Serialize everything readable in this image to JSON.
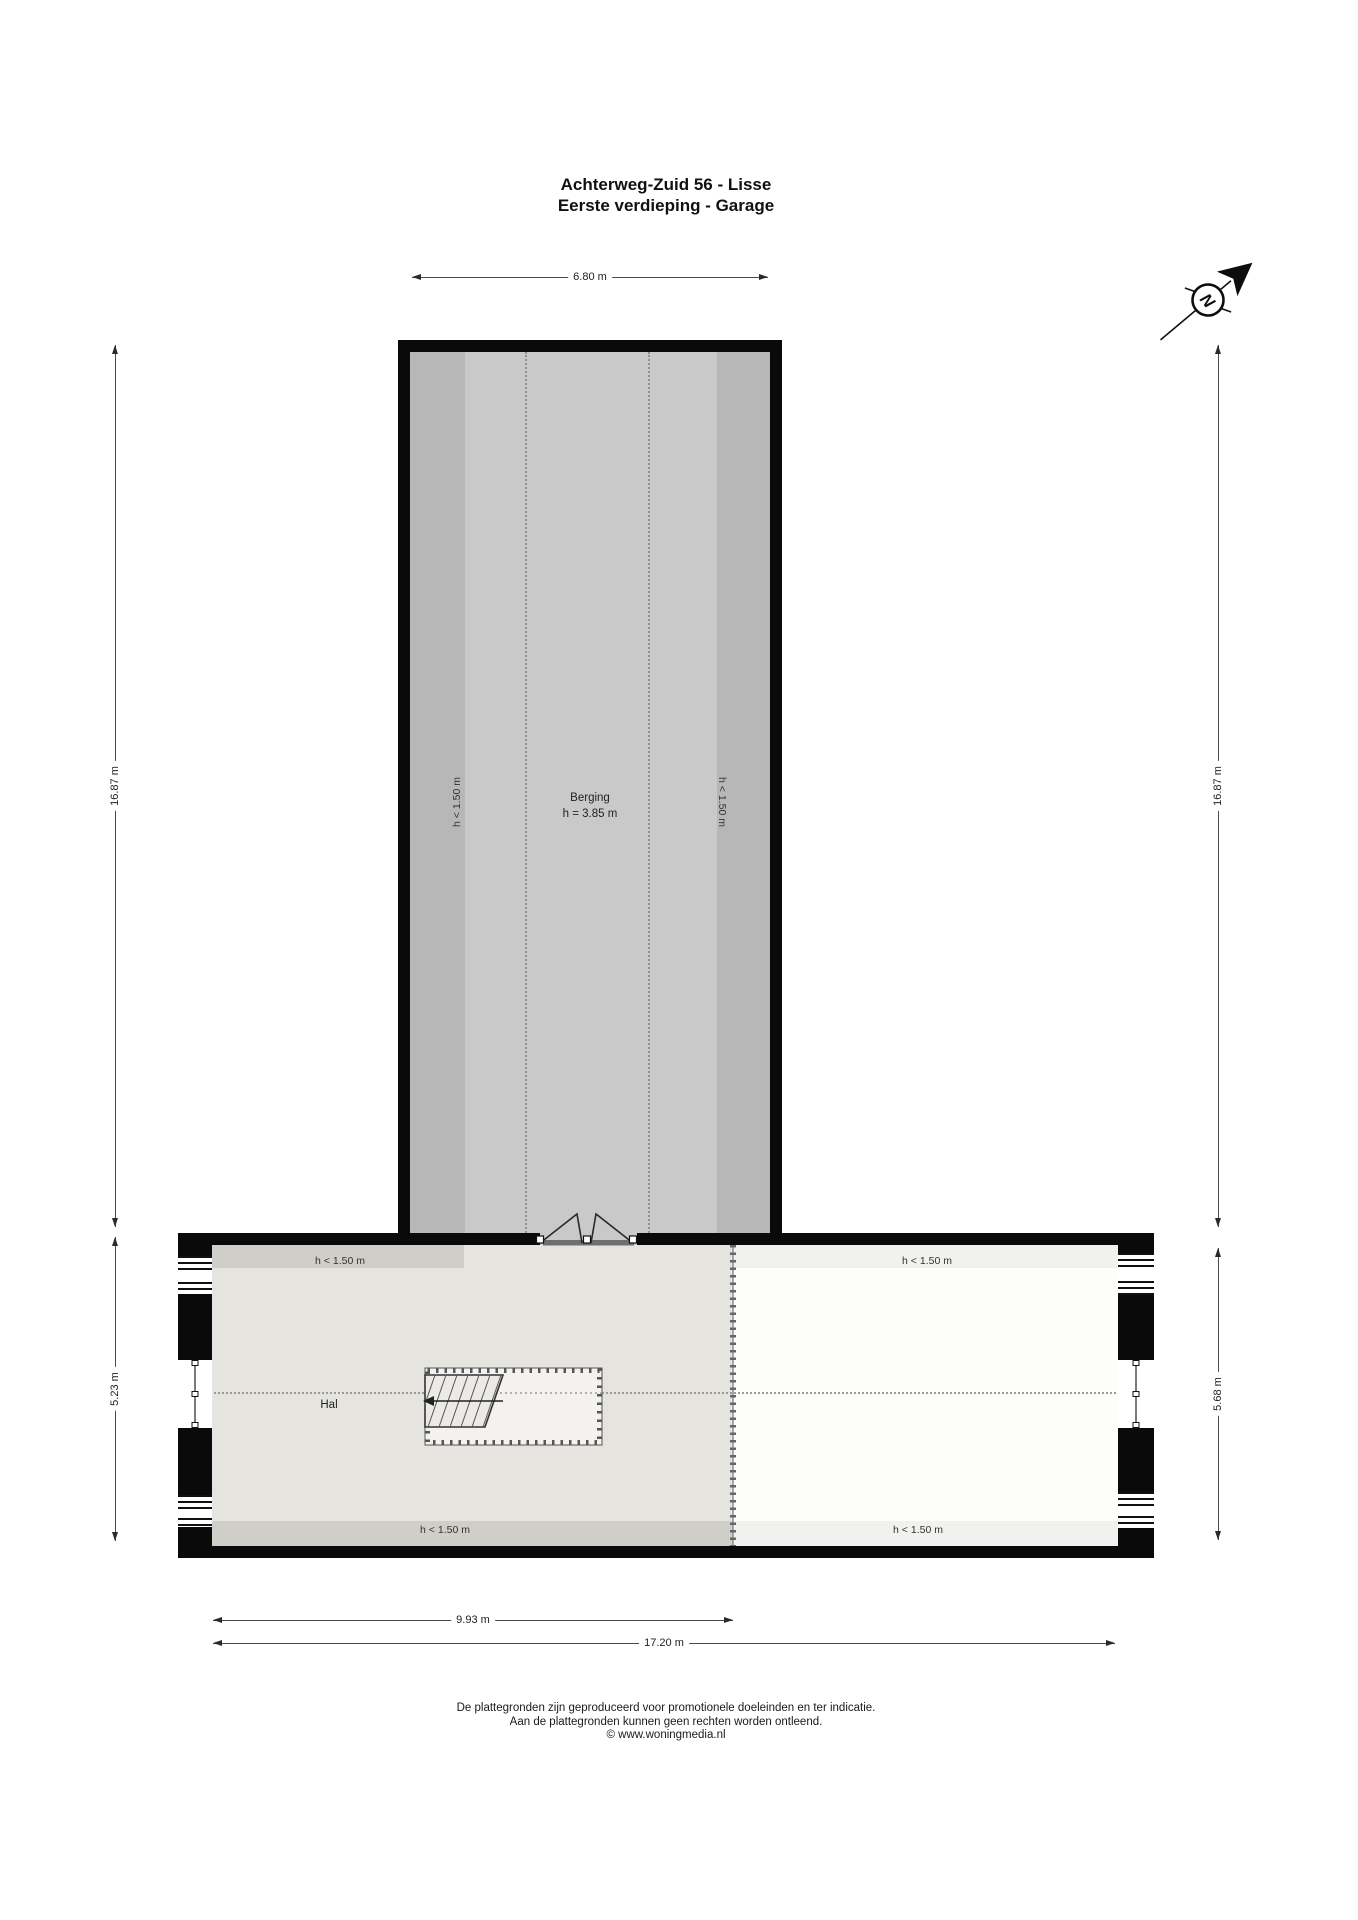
{
  "title": {
    "line1": "Achterweg-Zuid 56 - Lisse",
    "line2": "Eerste verdieping - Garage"
  },
  "compass": {
    "north_label": "N"
  },
  "labels": {
    "low_height": "h < 1.50 m"
  },
  "rooms": {
    "berging": {
      "name": "Berging",
      "height_note": "h = 3.85 m"
    },
    "hal": {
      "name": "Hal"
    }
  },
  "dimensions": {
    "berging_width": "6.80 m",
    "left_total_height": "16.87 m",
    "right_total_height": "16.87 m",
    "hal_section_height": "5.23 m",
    "right_section_height": "5.68 m",
    "hal_width": "9.93 m",
    "total_width": "17.20 m"
  },
  "footer": {
    "line1": "De plattegronden zijn geproduceerd voor promotionele doeleinden en ter indicatie.",
    "line2": "Aan de plattegronden kunnen geen rechten worden ontleend.",
    "line3": "© www.woningmedia.nl"
  },
  "colors": {
    "wall": "#0a0a0a",
    "berging_fill": "#c9c9c9",
    "berging_low_fill": "#b7b7b7",
    "hal_fill": "#e5e4df",
    "hal_low_fill": "#cfcec9",
    "right_room_fill": "#fdfdfc",
    "right_room_low_fill": "#f1f1f0"
  }
}
